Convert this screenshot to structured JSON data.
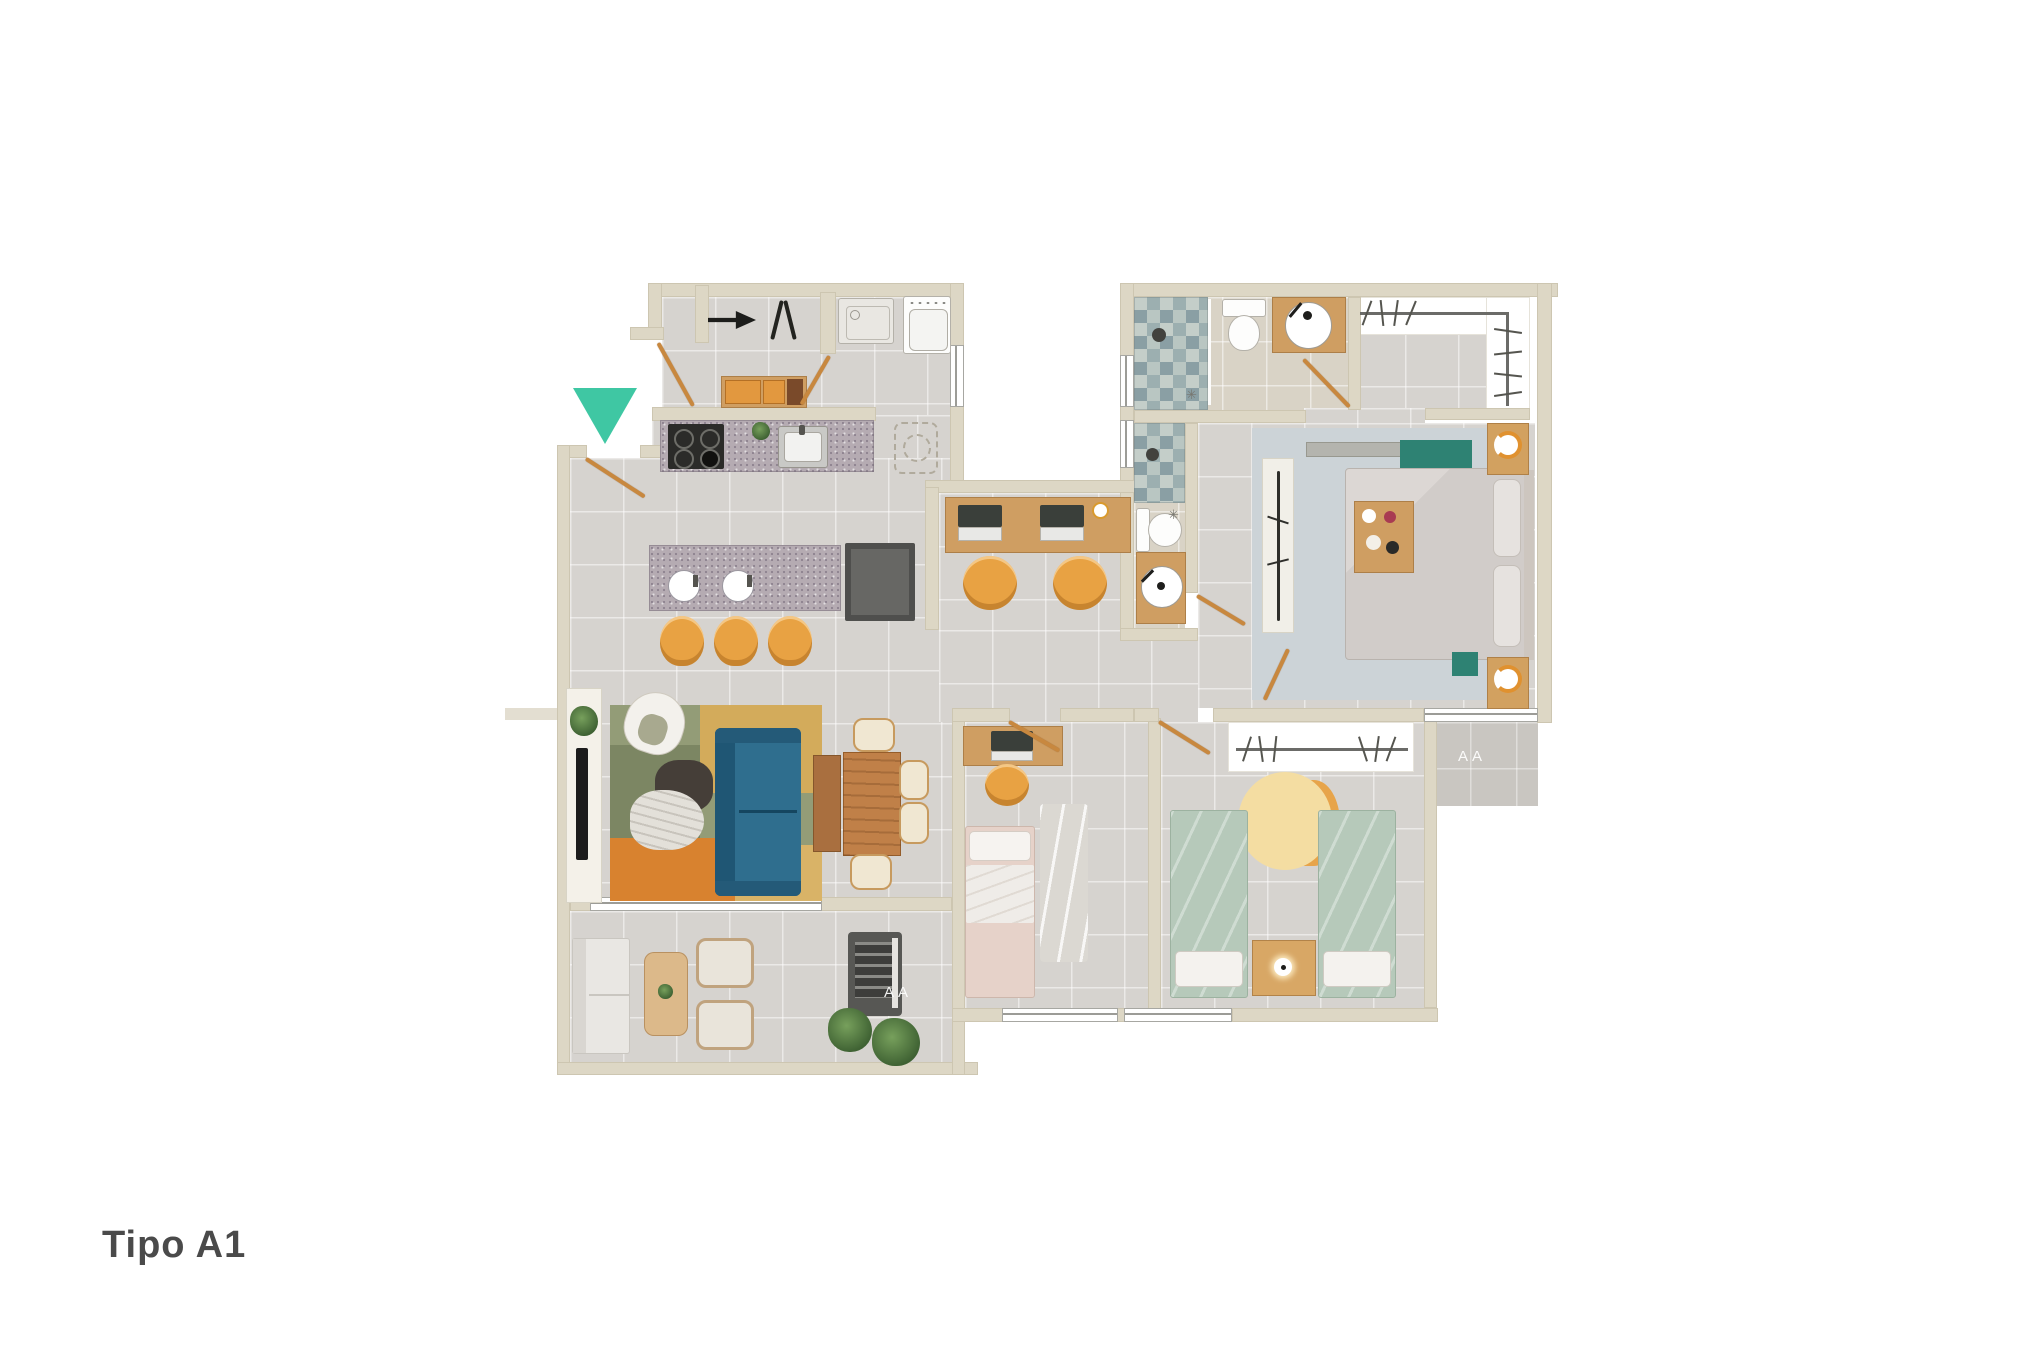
{
  "title": "Tipo A1",
  "footer": {
    "unit_label": "Tipo A1"
  },
  "labels": {
    "ac_unit_left": "AA",
    "ac_unit_right": "AA"
  },
  "icons": {
    "floor_drain": "✳"
  },
  "colors": {
    "entrance_marker": "#3fc7a3",
    "wall": "#ddd7c5",
    "floor_gray": "#d6d3cf",
    "floor_bath": "#d9d3c6",
    "accent_orange": "#e8a243",
    "door_wood": "#c8883f",
    "sofa_blue": "#2b6485",
    "bed_green": "#b6c9ba",
    "bed_pink": "#e6d2c9",
    "teal_accent": "#2e8273",
    "text_dark": "#4a4a4a"
  },
  "rooms": [
    "entrance",
    "laundry",
    "kitchen",
    "living-dining",
    "balcony",
    "study-nook",
    "bathroom-1",
    "bathroom-2",
    "walk-in-closet",
    "master-bedroom",
    "bedroom-2",
    "bedroom-3",
    "ac-platform"
  ]
}
